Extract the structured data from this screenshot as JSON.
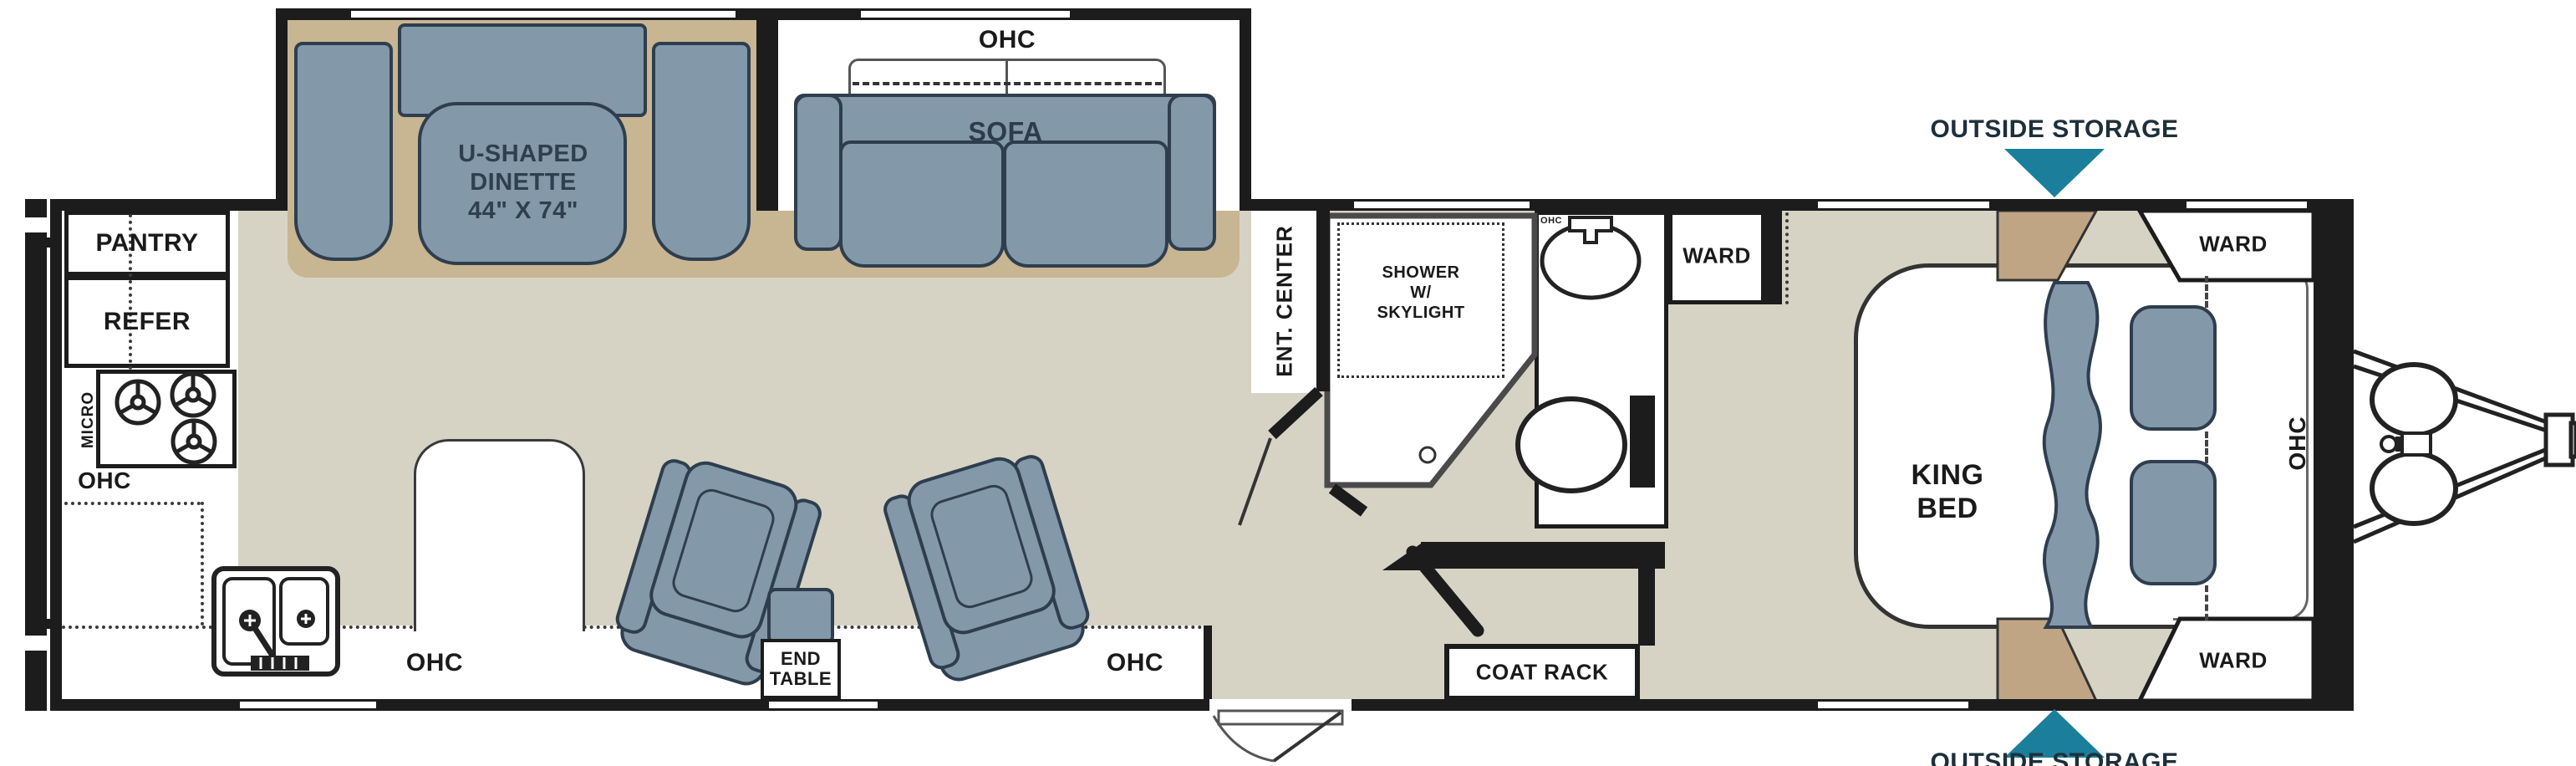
{
  "figure": "Travel trailer floor plan with rear kitchen, U-shaped dinette and sofa slide-out, bathroom and front king bedroom",
  "colors": {
    "wall": "#1c1c1c",
    "floor": "#d6d3c4",
    "slide_floor_tan": "#c8b592",
    "storage_wedge_tan": "#bfa583",
    "furniture_blue": "#8398a9",
    "furniture_outline": "#2e3e4e",
    "accent_teal": "#1b7e9b",
    "label_text": "#1a1a1a",
    "white": "#ffffff"
  },
  "labels": {
    "pantry": "PANTRY",
    "refer": "REFER",
    "micro": "MICRO",
    "ohc": "OHC",
    "dinette_line1": "U-SHAPED",
    "dinette_line2": "DINETTE",
    "dinette_line3": "44\" X 74\"",
    "sofa": "SOFA",
    "ent_center": "ENT. CENTER",
    "shower_line1": "SHOWER",
    "shower_line2": "W/",
    "shower_line3": "SKYLIGHT",
    "ward": "WARD",
    "king_line1": "KING",
    "king_line2": "BED",
    "end_table_line1": "END",
    "end_table_line2": "TABLE",
    "coat_rack": "COAT RACK",
    "outside_storage": "OUTSIDE STORAGE"
  }
}
